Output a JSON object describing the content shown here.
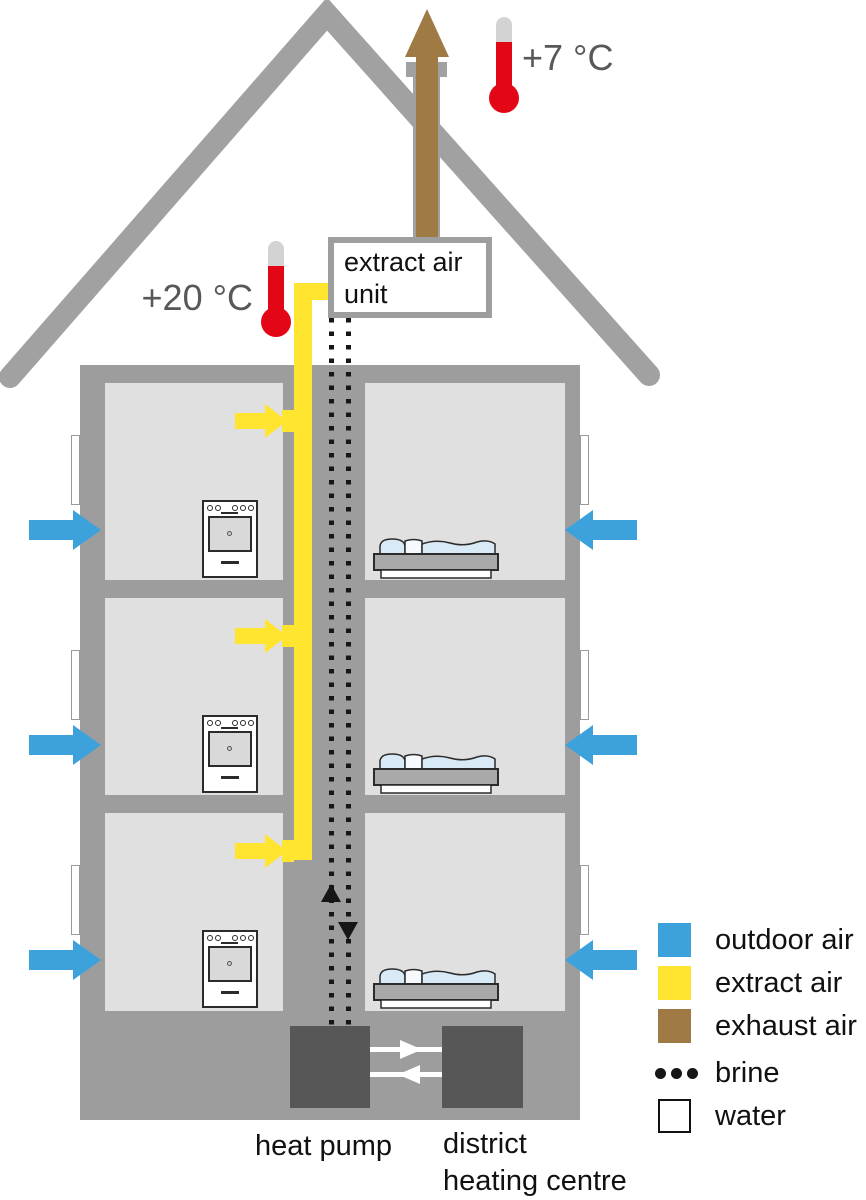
{
  "diagram": {
    "type": "building-ventilation-heat-pump-schematic",
    "floors": 3,
    "temperatures": {
      "exhaust_outdoor": "+7 °C",
      "indoor_extract": "+20 °C"
    },
    "extract_air_unit": {
      "line1": "extract air",
      "line2": "unit"
    },
    "basement": {
      "heat_pump_label": "heat pump",
      "district_heating_line1": "district",
      "district_heating_line2": "heating centre"
    }
  },
  "legend": {
    "items": [
      {
        "id": "outdoor-air",
        "label": "outdoor air",
        "color": "#3DA2DB"
      },
      {
        "id": "extract-air",
        "label": "extract air",
        "color": "#FFE430"
      },
      {
        "id": "exhaust-air",
        "label": "exhaust air",
        "color": "#A07A45"
      },
      {
        "id": "brine",
        "label": "brine",
        "color": "#161616"
      },
      {
        "id": "water",
        "label": "water",
        "color": "#FFFFFF"
      }
    ]
  },
  "colors": {
    "outdoor_air": "#3DA2DB",
    "extract_air": "#FFE430",
    "exhaust_air": "#A07A45",
    "brine": "#161616",
    "water": "#FFFFFF",
    "roof": "#A1A1A1",
    "wall": "#9D9D9D",
    "room": "#E0E0E0",
    "equipment_box": "#575757",
    "thermometer_red": "#E30617",
    "temp_text": "#58585A"
  }
}
